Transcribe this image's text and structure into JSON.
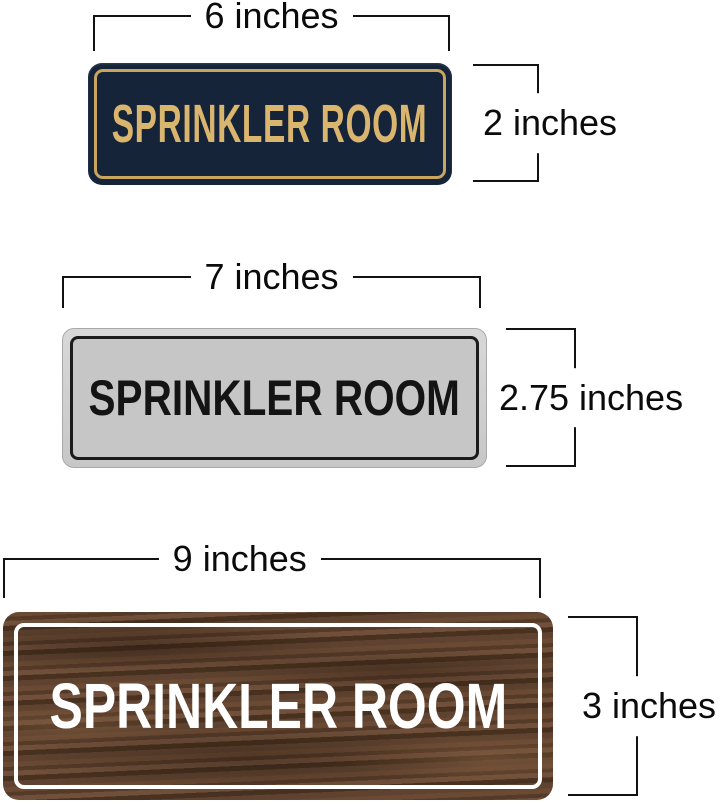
{
  "figure": {
    "description": "Size comparison diagram of three SPRINKLER ROOM door signs",
    "background_color": "#ffffff",
    "dimension_line_color": "#121212"
  },
  "signs": [
    {
      "style": "navy-gold",
      "text": "SPRINKLER ROOM",
      "width_label": "6 inches",
      "height_label": "2 inches",
      "colors": {
        "background": "#16243A",
        "text": "#D9B56E",
        "border": "#C9A55F"
      }
    },
    {
      "style": "silver-black",
      "text": "SPRINKLER ROOM",
      "width_label": "7 inches",
      "height_label": "2.75 inches",
      "colors": {
        "background": "#C6C6C6",
        "rim": "#D8D8D8",
        "text": "#141414",
        "border": "#1B1B1B"
      }
    },
    {
      "style": "walnut-wood",
      "text": "SPRINKLER ROOM",
      "width_label": "9 inches",
      "height_label": "3 inches",
      "colors": {
        "background": "#5A3E2C",
        "text": "#FFFFFF",
        "border": "#FFFFFF"
      }
    }
  ]
}
